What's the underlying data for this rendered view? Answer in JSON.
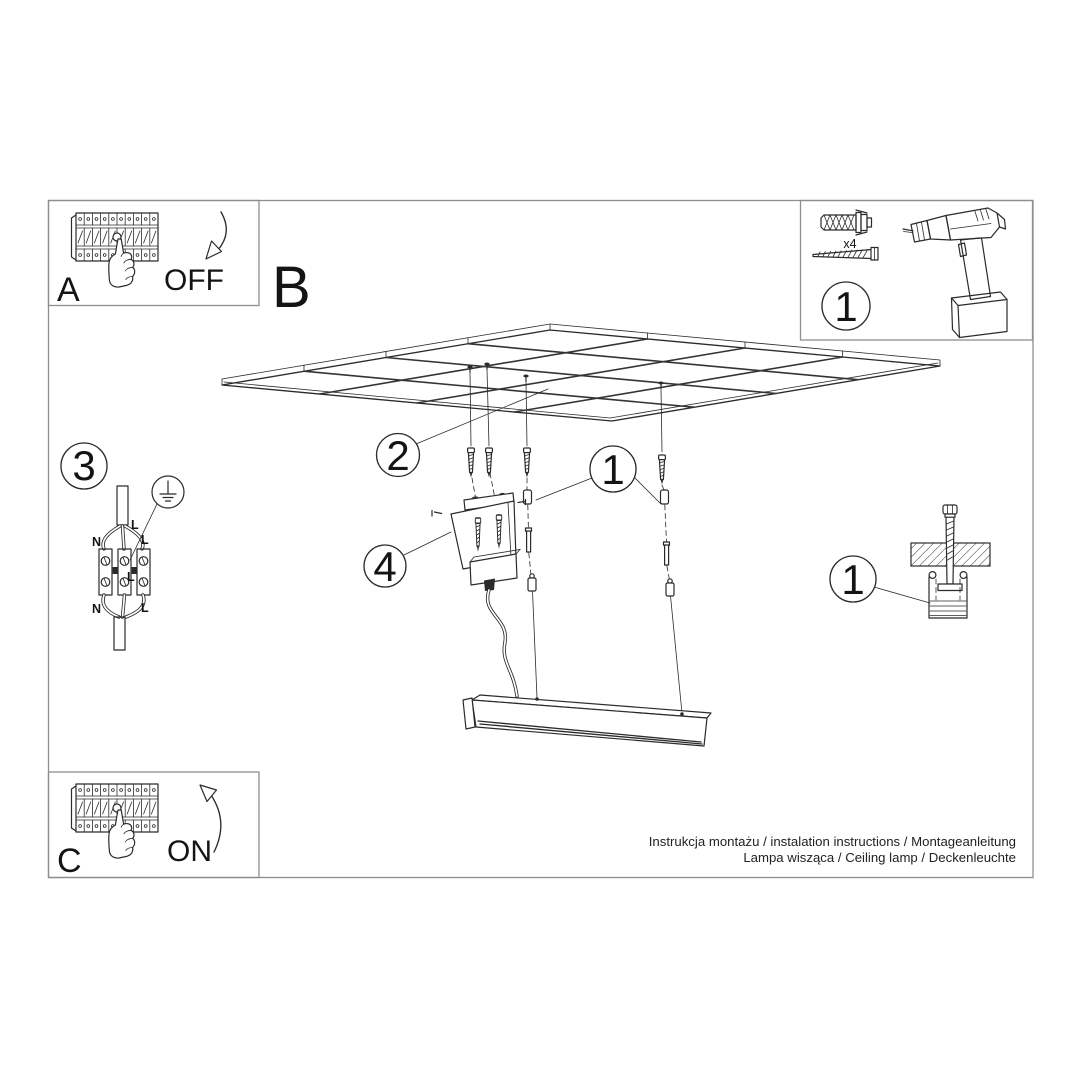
{
  "steps": {
    "power_off": {
      "label": "A",
      "state": "OFF"
    },
    "mounting": {
      "label": "B"
    },
    "power_on": {
      "label": "C",
      "state": "ON"
    }
  },
  "tools_box": {
    "step_number": "1",
    "screw_qty": "x4"
  },
  "wiring_diagram": {
    "step_number": "3",
    "labels": {
      "line_top": "L",
      "neutral_top": "N",
      "live_top": "L",
      "line_mid": "L",
      "neutral_bottom": "N",
      "live_bottom": "L"
    }
  },
  "callouts": {
    "ceiling_screws": "2",
    "suspension_kit": "1",
    "canopy": "4",
    "anchor_detail": "1"
  },
  "footer": {
    "line1": "Instrukcja montażu / instalation instructions / Montageanleitung",
    "line2": "Lampa wisząca / Ceiling lamp / Deckenleuchte"
  },
  "colors": {
    "ink": "#2b2b2b",
    "frame": "#8e8e8e",
    "background": "#ffffff"
  }
}
